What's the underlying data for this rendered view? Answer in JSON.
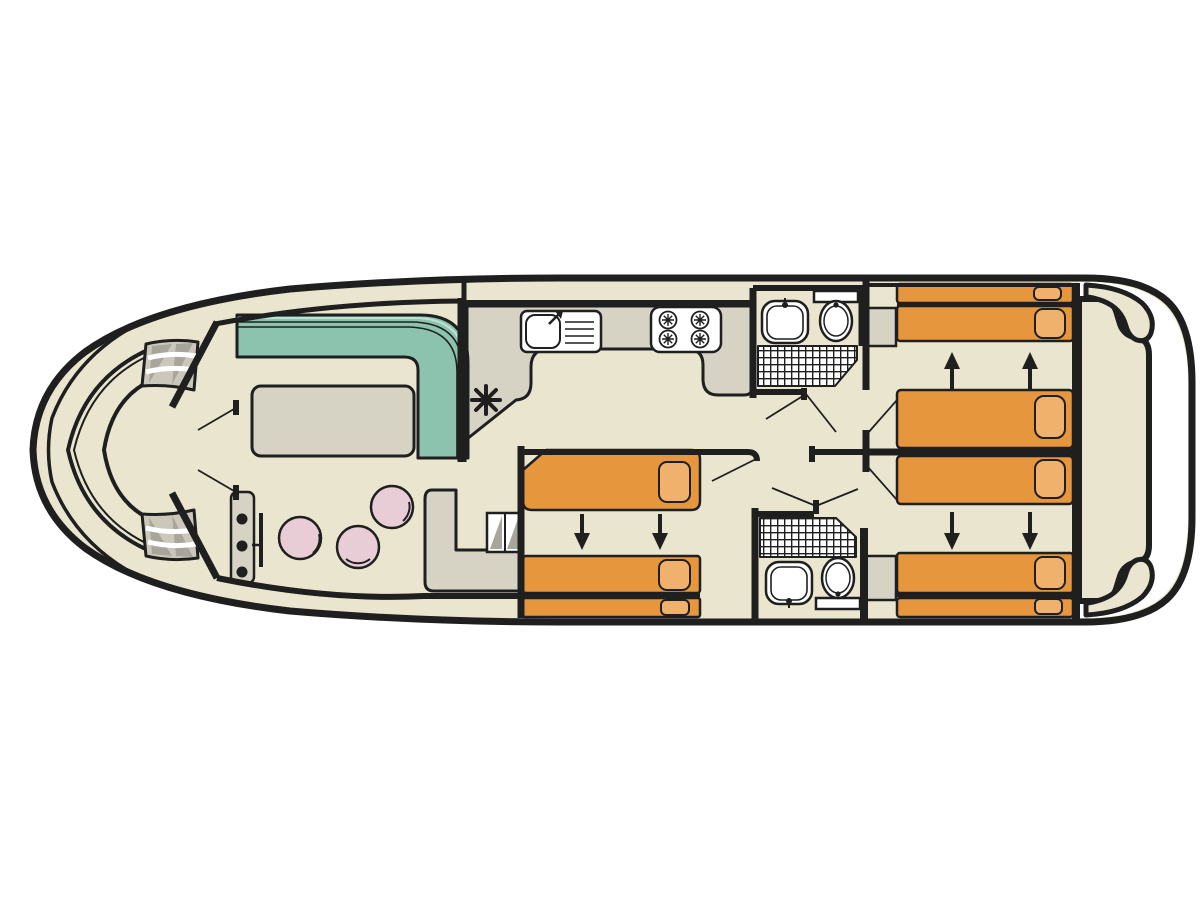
{
  "colors": {
    "background": "#ffffff",
    "outline": "#1f1f1f",
    "floor_beige": "#e9e5ce",
    "furniture_grey": "#d6d2c4",
    "step_grey": "#cbc8bb",
    "step_shadow": "#a8a69b",
    "sofa_teal": "#8cc3ae",
    "sofa_highlight": "#bfe0d4",
    "bed_orange": "#e6973e",
    "pillow_orange": "#f0b16c",
    "seat_pink": "#e8cdd6",
    "white": "#ffffff"
  },
  "icons": {
    "heater_asterisk": "✳"
  }
}
